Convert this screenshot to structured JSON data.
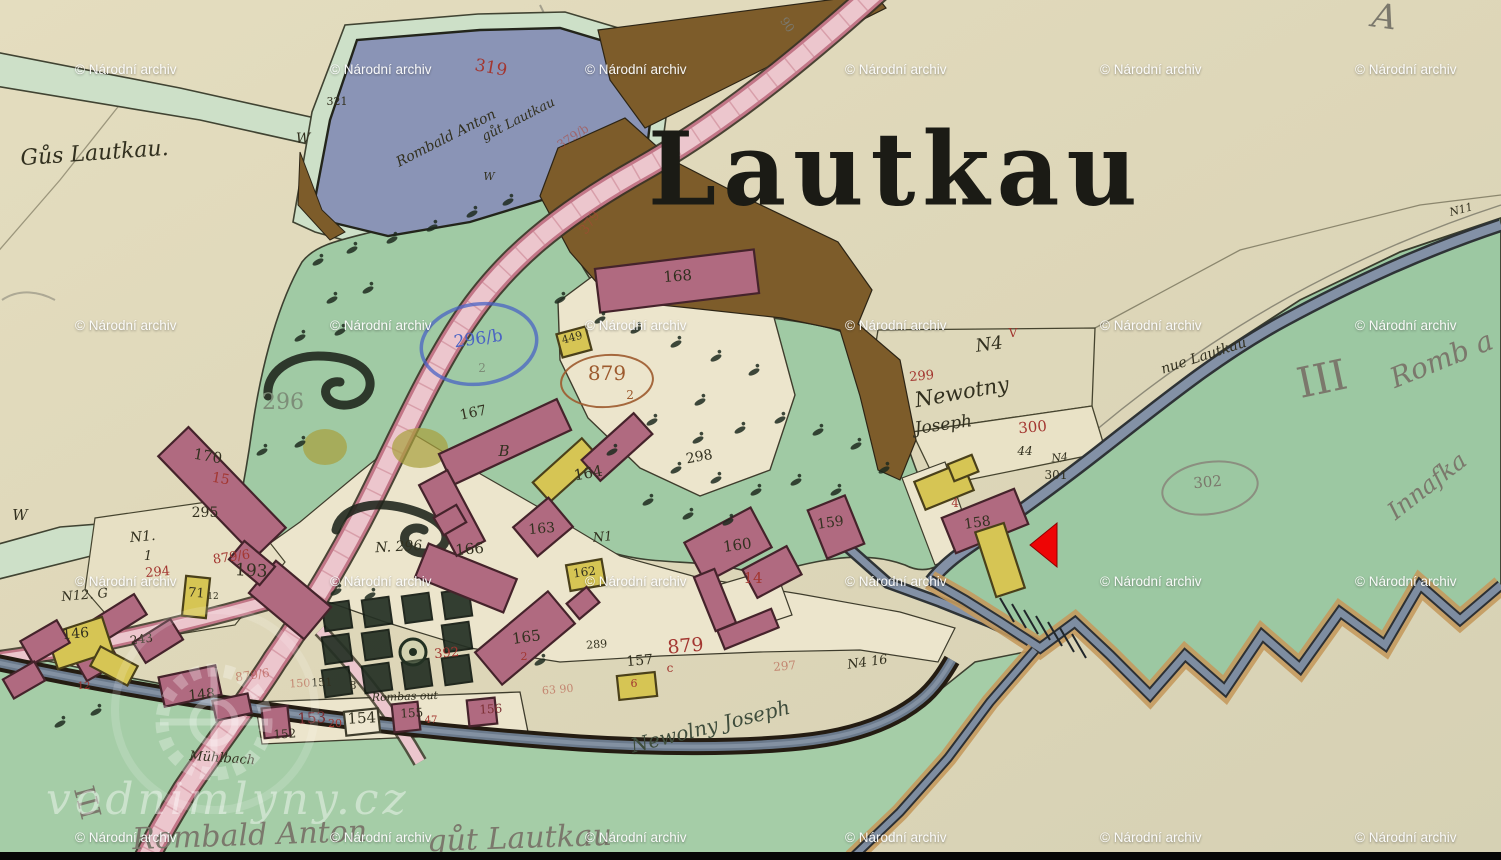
{
  "title": {
    "text": "Lautkau"
  },
  "watermark": {
    "text": "© Národní archiv",
    "cols": [
      75,
      330,
      585,
      845,
      1100,
      1355
    ],
    "rows": [
      71,
      327,
      583,
      839
    ]
  },
  "branding": {
    "text": "vodnimlyny.cz",
    "logo": "waterwheel-gear-icon"
  },
  "marker": {
    "shape": "left-pointing-triangle",
    "color": "#ee0505",
    "points": "1030,545 1057,523 1057,567"
  },
  "palette": {
    "paper": "#dfd8ba",
    "green_band": "#cde0c8",
    "meadow": "#a0caa4",
    "pond": "#8a94b6",
    "road_pink": "#ecc6cd",
    "road_edge": "#c27687",
    "brown": "#7d5c2a",
    "stream": "#8391a6",
    "building_pink": "#b06a80",
    "building_yellow": "#d6c554",
    "tan_bank": "#c49a5e",
    "ink": "#32301f",
    "red": "#a33630",
    "pencil": "#7b786c",
    "blue": "#4a63c4",
    "arrow": "#ee0505"
  },
  "label_colors": {
    "ink": "#32301f",
    "red": "#a33630",
    "fadedred": "rgba(175,70,55,0.55)",
    "redbrown": "#9d5a2e",
    "blue": "#4a63c4",
    "pencil": "#7b786c",
    "faded": "#7d8d78",
    "darkred": "#7c2f33",
    "inkgreen": "#3f4d3c"
  },
  "labels": [
    {
      "t": "Gůs Lautkau.",
      "x": 95,
      "y": 160,
      "s": 22,
      "r": -4,
      "c": "ink",
      "f": "cursive"
    },
    {
      "t": "321",
      "x": 337,
      "y": 105,
      "s": 11,
      "r": 0,
      "c": "ink"
    },
    {
      "t": "W",
      "x": 303,
      "y": 143,
      "s": 14,
      "r": 0,
      "c": "ink",
      "f": "cursive"
    },
    {
      "t": "W",
      "x": 489,
      "y": 180,
      "s": 11,
      "r": 0,
      "c": "ink",
      "f": "cursive"
    },
    {
      "t": "W",
      "x": 20,
      "y": 520,
      "s": 15,
      "r": 0,
      "c": "ink",
      "f": "cursive"
    },
    {
      "t": "319",
      "x": 490,
      "y": 73,
      "s": 17,
      "r": 10,
      "c": "red"
    },
    {
      "t": "Rombald Anton",
      "x": 448,
      "y": 142,
      "s": 14,
      "r": -27,
      "c": "ink",
      "f": "cursive"
    },
    {
      "t": "gůt Lautkau",
      "x": 520,
      "y": 123,
      "s": 13,
      "r": -27,
      "c": "ink",
      "f": "cursive"
    },
    {
      "t": "379/b",
      "x": 575,
      "y": 140,
      "s": 12,
      "r": -33,
      "c": "fadedred"
    },
    {
      "t": "379",
      "x": 593,
      "y": 225,
      "s": 13,
      "r": -55,
      "c": "fadedred"
    },
    {
      "t": "90",
      "x": 784,
      "y": 27,
      "s": 12,
      "r": 55,
      "c": "pencil"
    },
    {
      "t": "A",
      "x": 1383,
      "y": 28,
      "s": 34,
      "r": 8,
      "c": "pencil",
      "f": "cursive"
    },
    {
      "t": "N11",
      "x": 1462,
      "y": 213,
      "s": 11,
      "r": -15,
      "c": "ink",
      "f": "cursive"
    },
    {
      "t": "168",
      "x": 678,
      "y": 281,
      "s": 15,
      "r": -4,
      "c": "ink"
    },
    {
      "t": "296",
      "x": 283,
      "y": 409,
      "s": 22,
      "r": 0,
      "c": "faded"
    },
    {
      "t": "170",
      "x": 207,
      "y": 461,
      "s": 15,
      "r": 10,
      "c": "ink"
    },
    {
      "t": "15",
      "x": 220,
      "y": 483,
      "s": 14,
      "r": 10,
      "c": "red"
    },
    {
      "t": "295",
      "x": 205,
      "y": 517,
      "s": 14,
      "r": 0,
      "c": "ink"
    },
    {
      "t": "296/b",
      "x": 479,
      "y": 344,
      "s": 17,
      "r": -8,
      "c": "blue"
    },
    {
      "t": "2",
      "x": 482,
      "y": 372,
      "s": 12,
      "r": 0,
      "c": "faded"
    },
    {
      "t": "449",
      "x": 573,
      "y": 341,
      "s": 11,
      "r": -15,
      "c": "ink"
    },
    {
      "t": "879",
      "x": 607,
      "y": 380,
      "s": 20,
      "r": 0,
      "c": "redbrown"
    },
    {
      "t": "2",
      "x": 630,
      "y": 399,
      "s": 12,
      "r": 0,
      "c": "redbrown"
    },
    {
      "t": "167",
      "x": 474,
      "y": 417,
      "s": 14,
      "r": -12,
      "c": "ink"
    },
    {
      "t": "B",
      "x": 504,
      "y": 456,
      "s": 15,
      "r": 0,
      "c": "ink",
      "f": "cursive"
    },
    {
      "t": "164",
      "x": 589,
      "y": 478,
      "s": 15,
      "r": -10,
      "c": "ink"
    },
    {
      "t": "298",
      "x": 700,
      "y": 461,
      "s": 14,
      "r": -10,
      "c": "ink"
    },
    {
      "t": "N. 296",
      "x": 399,
      "y": 551,
      "s": 14,
      "r": -3,
      "c": "ink",
      "f": "cursive"
    },
    {
      "t": "163",
      "x": 542,
      "y": 533,
      "s": 14,
      "r": -5,
      "c": "ink"
    },
    {
      "t": "166",
      "x": 470,
      "y": 554,
      "s": 15,
      "r": -5,
      "c": "ink"
    },
    {
      "t": "N1",
      "x": 603,
      "y": 541,
      "s": 13,
      "r": -5,
      "c": "ink",
      "f": "cursive"
    },
    {
      "t": "162",
      "x": 585,
      "y": 576,
      "s": 12,
      "r": -8,
      "c": "ink"
    },
    {
      "t": "160",
      "x": 738,
      "y": 550,
      "s": 15,
      "r": -8,
      "c": "ink"
    },
    {
      "t": "14",
      "x": 753,
      "y": 583,
      "s": 15,
      "r": 0,
      "c": "red"
    },
    {
      "t": "159",
      "x": 831,
      "y": 527,
      "s": 14,
      "r": -8,
      "c": "ink"
    },
    {
      "t": "165",
      "x": 527,
      "y": 642,
      "s": 15,
      "r": -8,
      "c": "ink"
    },
    {
      "t": "2",
      "x": 524,
      "y": 660,
      "s": 11,
      "r": 0,
      "c": "red"
    },
    {
      "t": "289",
      "x": 597,
      "y": 648,
      "s": 11,
      "r": -5,
      "c": "ink"
    },
    {
      "t": "879",
      "x": 686,
      "y": 652,
      "s": 19,
      "r": -5,
      "c": "red"
    },
    {
      "t": "c",
      "x": 670,
      "y": 672,
      "s": 12,
      "r": 0,
      "c": "red"
    },
    {
      "t": "157",
      "x": 640,
      "y": 665,
      "s": 14,
      "r": -5,
      "c": "ink"
    },
    {
      "t": "6",
      "x": 634,
      "y": 687,
      "s": 11,
      "r": 0,
      "c": "red"
    },
    {
      "t": "297",
      "x": 785,
      "y": 670,
      "s": 12,
      "r": -5,
      "c": "fadedred"
    },
    {
      "t": "N4 16",
      "x": 868,
      "y": 666,
      "s": 13,
      "r": -8,
      "c": "ink",
      "f": "cursive"
    },
    {
      "t": "63 90",
      "x": 558,
      "y": 693,
      "s": 11,
      "r": -5,
      "c": "fadedred"
    },
    {
      "t": "Newolny Joseph",
      "x": 712,
      "y": 733,
      "s": 20,
      "r": -14,
      "c": "inkgreen",
      "f": "cursive"
    },
    {
      "t": "N4",
      "x": 990,
      "y": 350,
      "s": 18,
      "r": -8,
      "c": "ink",
      "f": "cursive"
    },
    {
      "t": "V",
      "x": 1013,
      "y": 337,
      "s": 12,
      "r": 0,
      "c": "red"
    },
    {
      "t": "299",
      "x": 922,
      "y": 380,
      "s": 13,
      "r": -5,
      "c": "red"
    },
    {
      "t": "Newotny",
      "x": 963,
      "y": 399,
      "s": 21,
      "r": -10,
      "c": "ink",
      "f": "cursive"
    },
    {
      "t": "Joseph",
      "x": 944,
      "y": 430,
      "s": 17,
      "r": -8,
      "c": "ink",
      "f": "cursive"
    },
    {
      "t": "300",
      "x": 1033,
      "y": 432,
      "s": 15,
      "r": -5,
      "c": "red"
    },
    {
      "t": "44",
      "x": 1025,
      "y": 455,
      "s": 12,
      "r": 0,
      "c": "ink",
      "f": "cursive"
    },
    {
      "t": "N4",
      "x": 1060,
      "y": 461,
      "s": 11,
      "r": -5,
      "c": "ink",
      "f": "cursive"
    },
    {
      "t": "301",
      "x": 1056,
      "y": 479,
      "s": 12,
      "r": 0,
      "c": "ink"
    },
    {
      "t": "4",
      "x": 955,
      "y": 507,
      "s": 12,
      "r": 0,
      "c": "red"
    },
    {
      "t": "158",
      "x": 978,
      "y": 527,
      "s": 14,
      "r": -8,
      "c": "ink"
    },
    {
      "t": "nue Lautkau",
      "x": 1205,
      "y": 360,
      "s": 14,
      "r": -18,
      "c": "ink",
      "f": "cursive"
    },
    {
      "t": "III",
      "x": 1325,
      "y": 393,
      "s": 42,
      "r": -12,
      "c": "pencil"
    },
    {
      "t": "Romb a",
      "x": 1445,
      "y": 368,
      "s": 28,
      "r": -22,
      "c": "pencil",
      "f": "cursive"
    },
    {
      "t": "302",
      "x": 1208,
      "y": 487,
      "s": 15,
      "r": -5,
      "c": "pencil"
    },
    {
      "t": "Innafka",
      "x": 1432,
      "y": 492,
      "s": 24,
      "r": -38,
      "c": "pencil",
      "f": "cursive"
    },
    {
      "t": "N1.",
      "x": 143,
      "y": 541,
      "s": 14,
      "r": -5,
      "c": "ink",
      "f": "cursive"
    },
    {
      "t": "1",
      "x": 148,
      "y": 560,
      "s": 13,
      "r": 0,
      "c": "ink",
      "f": "cursive"
    },
    {
      "t": "294",
      "x": 158,
      "y": 576,
      "s": 13,
      "r": -5,
      "c": "red"
    },
    {
      "t": "879/6",
      "x": 232,
      "y": 561,
      "s": 13,
      "r": -8,
      "c": "red"
    },
    {
      "t": "193",
      "x": 251,
      "y": 576,
      "s": 17,
      "r": 3,
      "c": "ink"
    },
    {
      "t": "N12. G",
      "x": 85,
      "y": 599,
      "s": 13,
      "r": -5,
      "c": "ink",
      "f": "cursive"
    },
    {
      "t": "71",
      "x": 196,
      "y": 597,
      "s": 13,
      "r": 5,
      "c": "ink"
    },
    {
      "t": "12",
      "x": 213,
      "y": 599,
      "s": 9,
      "r": 0,
      "c": "ink"
    },
    {
      "t": "146",
      "x": 76,
      "y": 638,
      "s": 14,
      "r": -5,
      "c": "ink"
    },
    {
      "t": "243",
      "x": 142,
      "y": 643,
      "s": 12,
      "r": -8,
      "c": "ink"
    },
    {
      "t": "12",
      "x": 84,
      "y": 689,
      "s": 10,
      "r": 0,
      "c": "red"
    },
    {
      "t": "148",
      "x": 202,
      "y": 699,
      "s": 14,
      "r": -5,
      "c": "ink"
    },
    {
      "t": "879/6",
      "x": 253,
      "y": 679,
      "s": 12,
      "r": -8,
      "c": "fadedred"
    },
    {
      "t": "150",
      "x": 300,
      "y": 687,
      "s": 11,
      "r": -3,
      "c": "fadedred"
    },
    {
      "t": "151",
      "x": 322,
      "y": 686,
      "s": 11,
      "r": -3,
      "c": "ink"
    },
    {
      "t": "8",
      "x": 353,
      "y": 689,
      "s": 11,
      "r": 0,
      "c": "ink"
    },
    {
      "t": "152",
      "x": 285,
      "y": 738,
      "s": 12,
      "r": -3,
      "c": "ink"
    },
    {
      "t": "153",
      "x": 312,
      "y": 723,
      "s": 15,
      "r": -3,
      "c": "darkred"
    },
    {
      "t": "20",
      "x": 335,
      "y": 727,
      "s": 11,
      "r": 0,
      "c": "red"
    },
    {
      "t": "154",
      "x": 362,
      "y": 723,
      "s": 15,
      "r": -3,
      "c": "ink"
    },
    {
      "t": "155",
      "x": 412,
      "y": 717,
      "s": 12,
      "r": -3,
      "c": "ink"
    },
    {
      "t": "47",
      "x": 431,
      "y": 723,
      "s": 10,
      "r": 0,
      "c": "red"
    },
    {
      "t": "156",
      "x": 491,
      "y": 713,
      "s": 12,
      "r": -3,
      "c": "darkred"
    },
    {
      "t": "392",
      "x": 447,
      "y": 657,
      "s": 13,
      "r": -5,
      "c": "red"
    },
    {
      "t": "Rombas out",
      "x": 405,
      "y": 700,
      "s": 11,
      "r": -2,
      "c": "ink",
      "f": "cursive"
    },
    {
      "t": "Mühlbach",
      "x": 222,
      "y": 762,
      "s": 13,
      "r": 4,
      "c": "ink",
      "f": "cursive"
    },
    {
      "t": "III",
      "x": 78,
      "y": 805,
      "s": 28,
      "r": 75,
      "c": "pencil"
    },
    {
      "t": "Rombald Anton",
      "x": 250,
      "y": 845,
      "s": 30,
      "r": -2,
      "c": "pencil",
      "f": "cursive"
    },
    {
      "t": "gůt Lautkau",
      "x": 520,
      "y": 848,
      "s": 30,
      "r": -2,
      "c": "pencil",
      "f": "cursive"
    }
  ],
  "buildings": [
    [
      222,
      492,
      140,
      42,
      46,
      "p"
    ],
    [
      120,
      617,
      48,
      24,
      -32,
      "p"
    ],
    [
      158,
      641,
      44,
      24,
      -32,
      "p"
    ],
    [
      98,
      662,
      38,
      22,
      -30,
      "p"
    ],
    [
      80,
      643,
      58,
      36,
      -18,
      "y"
    ],
    [
      114,
      666,
      42,
      22,
      28,
      "y"
    ],
    [
      196,
      597,
      24,
      40,
      6,
      "y"
    ],
    [
      290,
      600,
      72,
      42,
      40,
      "p"
    ],
    [
      252,
      563,
      40,
      24,
      40,
      "p"
    ],
    [
      190,
      686,
      58,
      30,
      -12,
      "p"
    ],
    [
      232,
      707,
      36,
      20,
      -12,
      "p"
    ],
    [
      276,
      722,
      26,
      30,
      -6,
      "p"
    ],
    [
      362,
      722,
      34,
      24,
      -6,
      "w"
    ],
    [
      406,
      717,
      26,
      28,
      -6,
      "p"
    ],
    [
      482,
      712,
      28,
      26,
      -6,
      "p"
    ],
    [
      677,
      281,
      160,
      44,
      -7,
      "p"
    ],
    [
      574,
      342,
      30,
      24,
      -15,
      "y"
    ],
    [
      566,
      470,
      66,
      26,
      -42,
      "y"
    ],
    [
      617,
      447,
      70,
      28,
      -42,
      "p"
    ],
    [
      543,
      527,
      46,
      38,
      -40,
      "p"
    ],
    [
      586,
      575,
      36,
      26,
      -10,
      "y"
    ],
    [
      466,
      578,
      95,
      36,
      22,
      "p"
    ],
    [
      505,
      442,
      130,
      34,
      -25,
      "p"
    ],
    [
      452,
      513,
      80,
      32,
      62,
      "p"
    ],
    [
      728,
      545,
      75,
      45,
      -28,
      "p"
    ],
    [
      772,
      572,
      50,
      32,
      -28,
      "p"
    ],
    [
      836,
      527,
      40,
      52,
      -22,
      "p"
    ],
    [
      525,
      638,
      95,
      42,
      -40,
      "p"
    ],
    [
      583,
      603,
      26,
      20,
      -40,
      "p"
    ],
    [
      637,
      686,
      38,
      24,
      -6,
      "y"
    ],
    [
      985,
      521,
      78,
      38,
      -22,
      "p"
    ],
    [
      944,
      486,
      52,
      30,
      -22,
      "y"
    ],
    [
      1000,
      560,
      30,
      68,
      -18,
      "y"
    ],
    [
      963,
      468,
      26,
      18,
      -22,
      "y"
    ],
    [
      715,
      600,
      22,
      58,
      -22,
      "p"
    ],
    [
      748,
      629,
      58,
      20,
      -22,
      "p"
    ],
    [
      45,
      642,
      42,
      26,
      -30,
      "p"
    ],
    [
      24,
      680,
      36,
      22,
      -30,
      "p"
    ],
    [
      450,
      520,
      26,
      20,
      -30,
      "p"
    ]
  ],
  "trees": [
    [
      318,
      262
    ],
    [
      352,
      250
    ],
    [
      392,
      240
    ],
    [
      432,
      228
    ],
    [
      472,
      214
    ],
    [
      508,
      202
    ],
    [
      332,
      300
    ],
    [
      368,
      290
    ],
    [
      300,
      338
    ],
    [
      340,
      332
    ],
    [
      262,
      452
    ],
    [
      300,
      444
    ],
    [
      636,
      330
    ],
    [
      676,
      344
    ],
    [
      716,
      358
    ],
    [
      754,
      372
    ],
    [
      700,
      402
    ],
    [
      652,
      422
    ],
    [
      698,
      440
    ],
    [
      740,
      430
    ],
    [
      780,
      420
    ],
    [
      818,
      432
    ],
    [
      856,
      446
    ],
    [
      884,
      470
    ],
    [
      676,
      470
    ],
    [
      716,
      480
    ],
    [
      756,
      492
    ],
    [
      796,
      482
    ],
    [
      836,
      492
    ],
    [
      648,
      502
    ],
    [
      688,
      516
    ],
    [
      728,
      522
    ],
    [
      612,
      452
    ],
    [
      560,
      300
    ],
    [
      600,
      320
    ],
    [
      96,
      712
    ],
    [
      60,
      724
    ],
    [
      540,
      662
    ],
    [
      370,
      596
    ],
    [
      336,
      592
    ]
  ],
  "gardens": {
    "x0": 337,
    "y0": 616,
    "dx": 40,
    "dy": 33,
    "cols": 4,
    "rows": 3,
    "size": 27,
    "rot": -8,
    "col_drop_y": 4,
    "skip": [
      [
        1,
        2
      ]
    ],
    "circle": {
      "x": 413,
      "y": 652,
      "r": 13
    }
  },
  "ellipses": [
    {
      "x": 479,
      "y": 344,
      "rx": 58,
      "ry": 40,
      "rot": -8,
      "c": "#4a63c4",
      "w": 3.5,
      "o": 0.75
    },
    {
      "x": 607,
      "y": 381,
      "rx": 46,
      "ry": 26,
      "rot": -4,
      "c": "#9d5a2e",
      "w": 2,
      "o": 0.9
    },
    {
      "x": 1210,
      "y": 488,
      "rx": 48,
      "ry": 26,
      "rot": -8,
      "c": "#8a887c",
      "w": 2,
      "o": 0.9
    }
  ]
}
